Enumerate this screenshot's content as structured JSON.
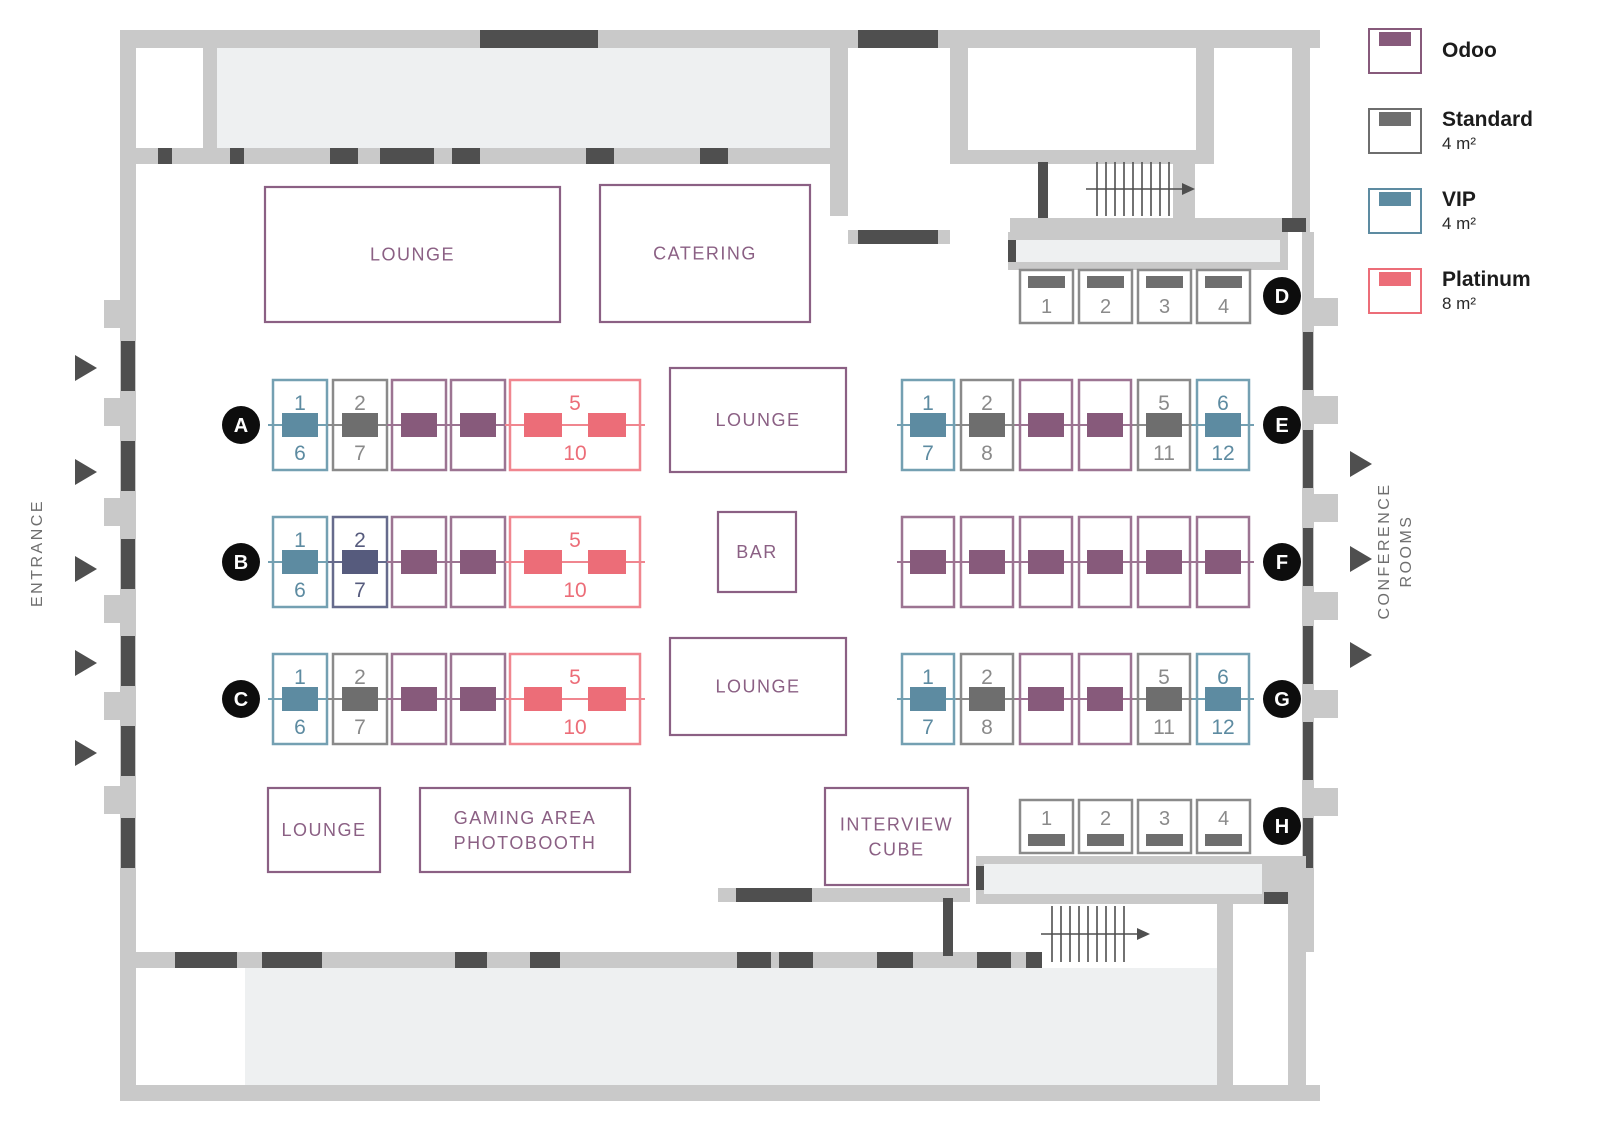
{
  "legend": {
    "items": [
      {
        "id": "odoo",
        "label": "Odoo",
        "size": ""
      },
      {
        "id": "standard",
        "label": "Standard",
        "size": "4 m²"
      },
      {
        "id": "vip",
        "label": "VIP",
        "size": "4 m²"
      },
      {
        "id": "platinum",
        "label": "Platinum",
        "size": "8 m²"
      }
    ]
  },
  "booth_types": {
    "odoo": {
      "bar": "#875a7b",
      "border": "#9c7492",
      "text": "#875a7b"
    },
    "standard": {
      "bar": "#6e6e6e",
      "border": "#8a8a8a",
      "text": "#8a8a8a"
    },
    "vip": {
      "bar": "#5d8ba1",
      "border": "#74a0b2",
      "text": "#5d8ba1"
    },
    "platinum": {
      "bar": "#ec6d78",
      "border": "#f0868f",
      "text": "#ec6d78"
    },
    "navy": {
      "bar": "#565b7d",
      "border": "#666b8c",
      "text": "#565b7d"
    }
  },
  "colors": {
    "wall": "#c9c9c9",
    "wall_dark": "#4f4f4f",
    "floor_area": "#eef0f1",
    "area_outline": "#8b6084",
    "badge": "#0d0d0d"
  },
  "labels": {
    "entrance": "ENTRANCE",
    "conference_line1": "CONFERENCE",
    "conference_line2": "ROOMS"
  },
  "areas": [
    {
      "id": "lounge-top",
      "lines": [
        "LOUNGE"
      ],
      "x": 265,
      "y": 187,
      "w": 295,
      "h": 135
    },
    {
      "id": "catering",
      "lines": [
        "CATERING"
      ],
      "x": 600,
      "y": 185,
      "w": 210,
      "h": 137
    },
    {
      "id": "lounge-center-top",
      "lines": [
        "LOUNGE"
      ],
      "x": 670,
      "y": 368,
      "w": 176,
      "h": 104
    },
    {
      "id": "bar",
      "lines": [
        "BAR"
      ],
      "x": 718,
      "y": 512,
      "w": 78,
      "h": 80
    },
    {
      "id": "lounge-center-bottom",
      "lines": [
        "LOUNGE"
      ],
      "x": 670,
      "y": 638,
      "w": 176,
      "h": 97
    },
    {
      "id": "lounge-bottom",
      "lines": [
        "LOUNGE"
      ],
      "x": 268,
      "y": 788,
      "w": 112,
      "h": 84
    },
    {
      "id": "gaming-photobooth",
      "lines": [
        "GAMING AREA",
        "PHOTOBOOTH"
      ],
      "x": 420,
      "y": 788,
      "w": 210,
      "h": 84
    },
    {
      "id": "interview-cube",
      "lines": [
        "INTERVIEW",
        "CUBE"
      ],
      "x": 825,
      "y": 788,
      "w": 143,
      "h": 97
    }
  ],
  "rows": [
    {
      "id": "A",
      "badge": "A",
      "kind": "double",
      "y": 380,
      "badge_x": 241,
      "booths": [
        {
          "type": "vip",
          "top": "1",
          "bottom": "6",
          "x": 273,
          "w": 54
        },
        {
          "type": "standard",
          "top": "2",
          "bottom": "7",
          "x": 333,
          "w": 54
        },
        {
          "type": "odoo",
          "x": 392,
          "w": 54
        },
        {
          "type": "odoo",
          "x": 451,
          "w": 54
        },
        {
          "type": "platinum",
          "top": "5",
          "bottom": "10",
          "x": 510,
          "w": 130,
          "bars": 2
        }
      ]
    },
    {
      "id": "B",
      "badge": "B",
      "kind": "double",
      "y": 517,
      "badge_x": 241,
      "booths": [
        {
          "type": "vip",
          "top": "1",
          "bottom": "6",
          "x": 273,
          "w": 54
        },
        {
          "type": "navy",
          "top": "2",
          "bottom": "7",
          "x": 333,
          "w": 54
        },
        {
          "type": "odoo",
          "x": 392,
          "w": 54
        },
        {
          "type": "odoo",
          "x": 451,
          "w": 54
        },
        {
          "type": "platinum",
          "top": "5",
          "bottom": "10",
          "x": 510,
          "w": 130,
          "bars": 2
        }
      ]
    },
    {
      "id": "C",
      "badge": "C",
      "kind": "double",
      "y": 654,
      "badge_x": 241,
      "booths": [
        {
          "type": "vip",
          "top": "1",
          "bottom": "6",
          "x": 273,
          "w": 54
        },
        {
          "type": "standard",
          "top": "2",
          "bottom": "7",
          "x": 333,
          "w": 54
        },
        {
          "type": "odoo",
          "x": 392,
          "w": 54
        },
        {
          "type": "odoo",
          "x": 451,
          "w": 54
        },
        {
          "type": "platinum",
          "top": "5",
          "bottom": "10",
          "x": 510,
          "w": 130,
          "bars": 2
        }
      ]
    },
    {
      "id": "E",
      "badge": "E",
      "kind": "double",
      "y": 380,
      "badge_x": 1282,
      "booths": [
        {
          "type": "vip",
          "top": "1",
          "bottom": "7",
          "x": 902,
          "w": 52
        },
        {
          "type": "standard",
          "top": "2",
          "bottom": "8",
          "x": 961,
          "w": 52
        },
        {
          "type": "odoo",
          "x": 1020,
          "w": 52
        },
        {
          "type": "odoo",
          "x": 1079,
          "w": 52
        },
        {
          "type": "standard",
          "top": "5",
          "bottom": "11",
          "x": 1138,
          "w": 52
        },
        {
          "type": "vip",
          "top": "6",
          "bottom": "12",
          "x": 1197,
          "w": 52
        }
      ]
    },
    {
      "id": "F",
      "badge": "F",
      "kind": "double",
      "y": 517,
      "badge_x": 1282,
      "booths": [
        {
          "type": "odoo",
          "x": 902,
          "w": 52
        },
        {
          "type": "odoo",
          "x": 961,
          "w": 52
        },
        {
          "type": "odoo",
          "x": 1020,
          "w": 52
        },
        {
          "type": "odoo",
          "x": 1079,
          "w": 52
        },
        {
          "type": "odoo",
          "x": 1138,
          "w": 52
        },
        {
          "type": "odoo",
          "x": 1197,
          "w": 52
        }
      ]
    },
    {
      "id": "G",
      "badge": "G",
      "kind": "double",
      "y": 654,
      "badge_x": 1282,
      "booths": [
        {
          "type": "vip",
          "top": "1",
          "bottom": "7",
          "x": 902,
          "w": 52
        },
        {
          "type": "standard",
          "top": "2",
          "bottom": "8",
          "x": 961,
          "w": 52
        },
        {
          "type": "odoo",
          "x": 1020,
          "w": 52
        },
        {
          "type": "odoo",
          "x": 1079,
          "w": 52
        },
        {
          "type": "standard",
          "top": "5",
          "bottom": "11",
          "x": 1138,
          "w": 52
        },
        {
          "type": "vip",
          "top": "6",
          "bottom": "12",
          "x": 1197,
          "w": 52
        }
      ]
    },
    {
      "id": "D",
      "badge": "D",
      "kind": "bar-top",
      "y": 270,
      "badge_x": 1282,
      "booths": [
        {
          "type": "standard",
          "num": "1",
          "x": 1020,
          "w": 53
        },
        {
          "type": "standard",
          "num": "2",
          "x": 1079,
          "w": 53
        },
        {
          "type": "standard",
          "num": "3",
          "x": 1138,
          "w": 53
        },
        {
          "type": "standard",
          "num": "4",
          "x": 1197,
          "w": 53
        }
      ]
    },
    {
      "id": "H",
      "badge": "H",
      "kind": "bar-bottom",
      "y": 800,
      "badge_x": 1282,
      "booths": [
        {
          "type": "standard",
          "num": "1",
          "x": 1020,
          "w": 53
        },
        {
          "type": "standard",
          "num": "2",
          "x": 1079,
          "w": 53
        },
        {
          "type": "standard",
          "num": "3",
          "x": 1138,
          "w": 53
        },
        {
          "type": "standard",
          "num": "4",
          "x": 1197,
          "w": 53
        }
      ]
    }
  ]
}
